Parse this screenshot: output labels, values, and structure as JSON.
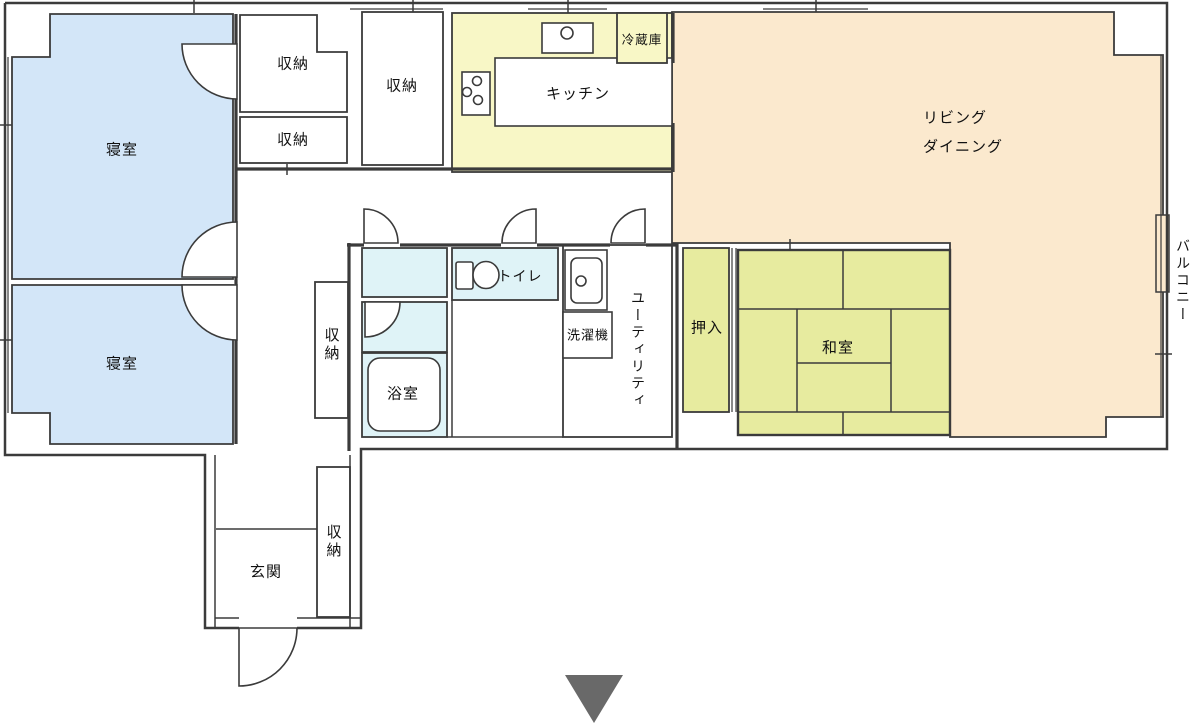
{
  "plan": {
    "rooms": {
      "bedroom_1": "寝室",
      "bedroom_2": "寝室",
      "storage_1": "収納",
      "storage_2": "収納",
      "storage_3": "収納",
      "storage_4": "収納",
      "storage_5": "収納",
      "kitchen": "キッチン",
      "refrigerator": "冷蔵庫",
      "living_line1": "リビング",
      "living_line2": "ダイニング",
      "balcony": "バルコニー",
      "closet_oshiire": "押入",
      "japanese_room": "和室",
      "toilet": "トイレ",
      "washing_machine": "洗濯機",
      "utility": "ユーティリティ",
      "bathroom": "浴室",
      "entrance": "玄関"
    },
    "colors": {
      "bedroom": "#d3e6f8",
      "kitchen": "#f8f7c6",
      "living": "#fbe9ce",
      "tatami": "#e7eb9f",
      "bath": "#dff3f7",
      "bathtub": "#eaf8fb",
      "white_room": "#ffffff",
      "wall": "#3b3b3b",
      "marker": "#696969"
    }
  }
}
